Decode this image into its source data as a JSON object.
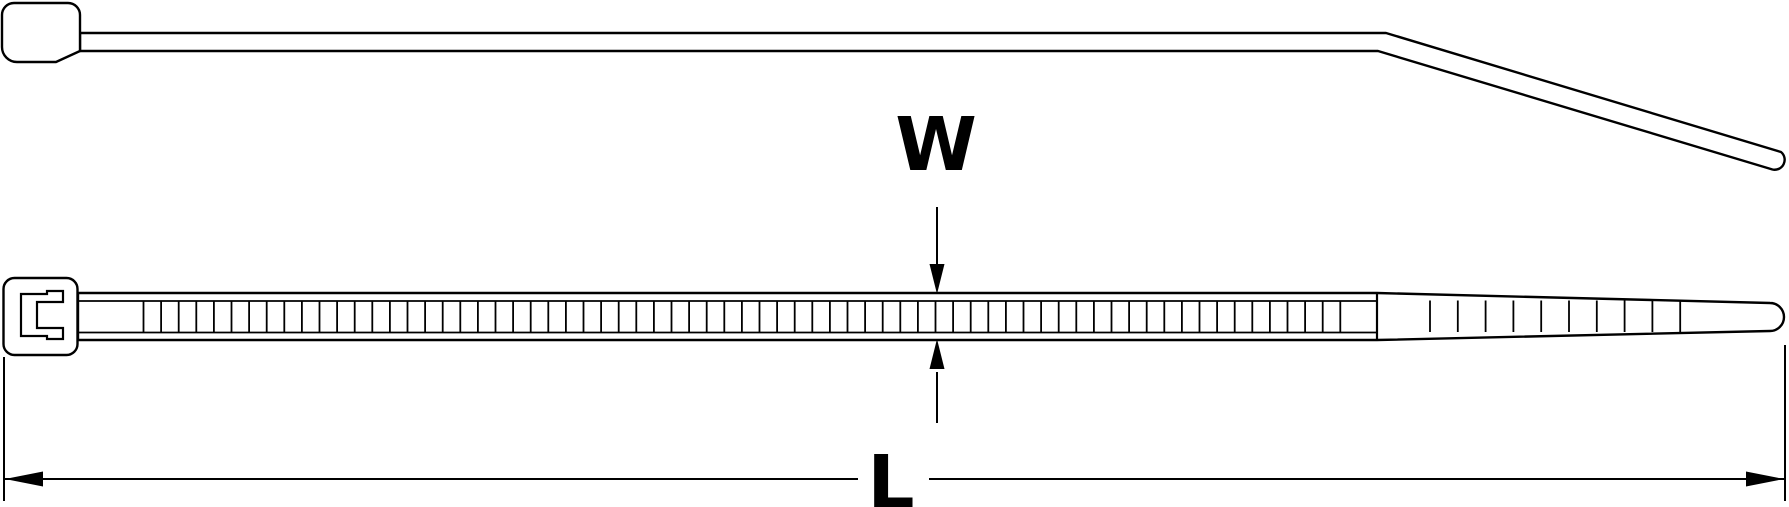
{
  "diagram": {
    "background_color": "#ffffff",
    "line_color": "#000000",
    "width_label": "W",
    "length_label": "L",
    "top_view": {
      "teeth_count": 69,
      "tail_rib_count": 10
    }
  }
}
